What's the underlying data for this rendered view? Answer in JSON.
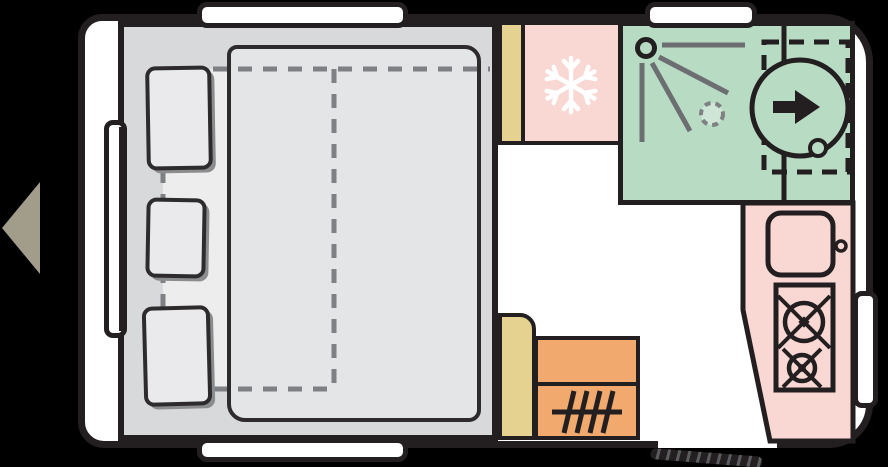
{
  "canvas": {
    "width": 888,
    "height": 467
  },
  "zones": {
    "caravan": "caravan floor plan",
    "tow_direction": "towing direction (front of caravan)",
    "bed": "fixed double bed with mattress",
    "bed_extension": "dashed bed outline",
    "pillow_1": "pillow",
    "pillow_2": "pillow",
    "pillow_3": "pillow",
    "cabinet_front": "front cabinet",
    "fridge": "refrigerator with freezer compartment",
    "bathroom": "washroom with shower and swivel toilet",
    "shower": "shower head with spray",
    "shower_drain": "shower drain",
    "toilet": "swivel cassette toilet",
    "kitchen": "kitchen unit",
    "sink": "kitchen sink with tap",
    "stove": "two-burner gas stove",
    "cabinet_rear": "rear cabinet",
    "heater": "heater unit",
    "entry_step": "entrance step",
    "entry_opening": "entrance door opening",
    "window_front_top": "front roadside window",
    "window_bath_top": "washroom window",
    "window_front_bottom": "front doorside window",
    "window_left": "front end window",
    "window_right": "entrance side window"
  },
  "icons": {
    "snowflake": "freezer / refrigerator symbol",
    "shower_spray": "shower spray symbol",
    "toilet_arrow": "toilet orientation arrow",
    "burner": "gas burner symbol",
    "heater_coil": "heater symbol",
    "tow_arrow": "direction-of-travel arrow"
  },
  "colors": {
    "background": "#000000",
    "outline": "#231f20",
    "interior": "#ffffff",
    "bed_base": "#d8d9db",
    "bed_light": "#ededee",
    "mattress": "#e4e5e7",
    "dash_gray": "#7e8083",
    "pillow": "#eaeaec",
    "pillow_shadow": "#8b8c8e",
    "cabinet_tan": "#e5d291",
    "fridge_pink": "#f9d7d3",
    "bath_green": "#b8dbc4",
    "drain_green": "#cfe6d6",
    "kitchen_pink": "#f9d7d3",
    "heater_orange": "#f1a96e",
    "tow_arrow": "#a29c8b",
    "spray_gray": "#6d6e71"
  }
}
